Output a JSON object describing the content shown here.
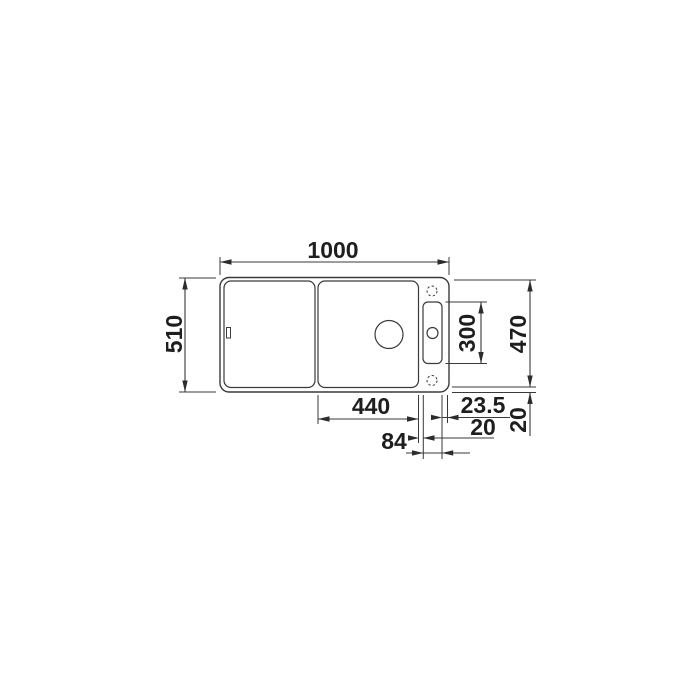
{
  "drawing": {
    "subject": "kitchen-sink-top-view-technical-drawing",
    "background": "#ffffff",
    "line_color": "#3a3a3a",
    "text_color": "#1e1e1e",
    "labels": {
      "overall_width": "1000",
      "overall_depth": "510",
      "ledge_length": "300",
      "inner_depth": "470",
      "bowl_width": "440",
      "ledge_to_edge": "23.5",
      "bowl_ledge_gap": "20",
      "ledge_width": "84",
      "rim_width": "20"
    }
  }
}
